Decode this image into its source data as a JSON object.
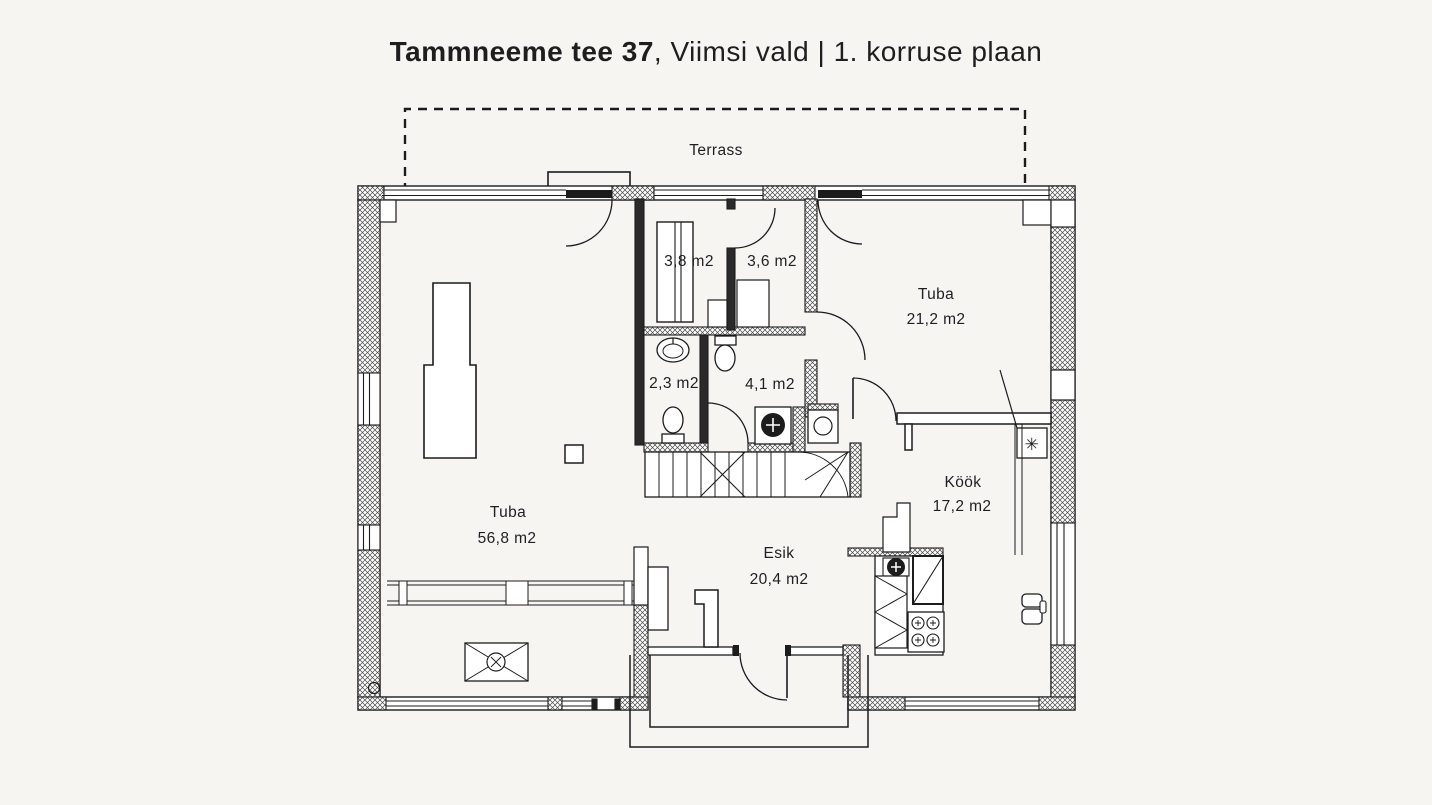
{
  "title": {
    "address_bold": "Tammneeme tee 37",
    "rest": ", Viimsi vald | 1. korruse plaan"
  },
  "terrace": {
    "label": "Terrass"
  },
  "rooms": {
    "closet": {
      "area": "3,8 m2"
    },
    "shower_room": {
      "area": "3,6 m2"
    },
    "bedroom": {
      "name": "Tuba",
      "area": "21,2 m2"
    },
    "wc": {
      "area": "2,3 m2"
    },
    "bathroom": {
      "area": "4,1 m2"
    },
    "living_room": {
      "name": "Tuba",
      "area": "56,8 m2"
    },
    "kitchen": {
      "name": "Köök",
      "area": "17,2 m2"
    },
    "hallway": {
      "name": "Esik",
      "area": "20,4 m2"
    }
  },
  "symbols": {
    "flue": "✳"
  },
  "colors": {
    "background": "#f7f5f2",
    "line": "#1c1c1c",
    "text": "#1f1f1f"
  }
}
